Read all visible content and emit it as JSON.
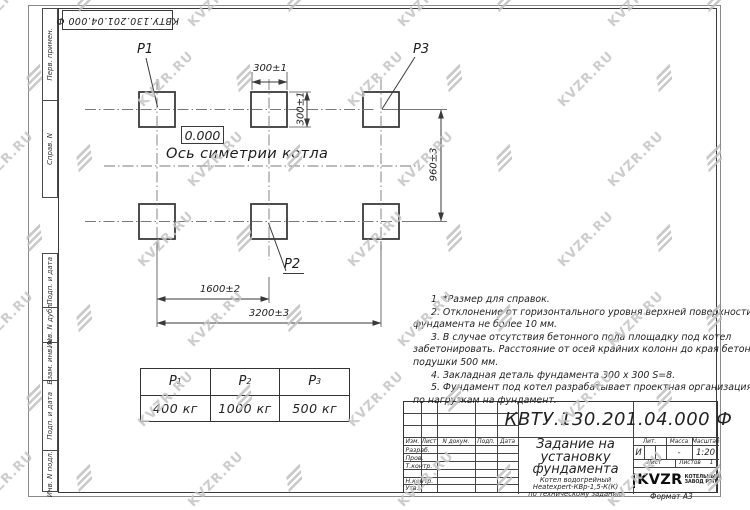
{
  "designation": "КВТУ.130.201.04.000  Ф",
  "labels": {
    "p1": "P1",
    "p2": "P2",
    "p3": "P3",
    "zero_mark": "0.000",
    "axis": "Ось симетрии котла"
  },
  "dims": {
    "w300": "300±1",
    "h300": "300±1",
    "v960": "960±3",
    "w1600": "1600±2",
    "w3200": "3200±3"
  },
  "notes": {
    "lines": [
      "1.  *Размер для справок.",
      "2.  Отклонение от горизонтального уровня верхней поверхности",
      "фундамента не более  10  мм.",
      "3.  В случае отсутствия бетонного пола площадку под котел",
      "забетонировать. Расстояние от осей крайних колонн до края бетонной",
      "подушки  500  мм.",
      "4.  Закладная деталь фундамента  300 х 300  S=8.",
      "5.  Фундамент под котел разрабатывает проектная организация",
      "по нагрузкам на фундамент."
    ]
  },
  "load_table": {
    "headers": [
      {
        "sym": "P",
        "sub": "1"
      },
      {
        "sym": "P",
        "sub": "2"
      },
      {
        "sym": "P",
        "sub": "3"
      }
    ],
    "values": [
      "400  кг",
      "1000  кг",
      "500  кг"
    ]
  },
  "margin": {
    "top_cells": [
      "Перв. примен.",
      "Справ. N"
    ],
    "bottom_cells": [
      "Подп. и дата",
      "Инв. N дубл.",
      "Взам. инв. N",
      "Подп. и дата",
      "Инв. N подл."
    ]
  },
  "titleblock": {
    "columns": [
      "Изм.",
      "Лист",
      "N докум.",
      "Подп.",
      "Дата"
    ],
    "sign_rows": [
      "Разраб.",
      "Пров.",
      "Т.контр.",
      "",
      "Н.контр.",
      "Утв."
    ],
    "title_lines": [
      "Задание на",
      "установку",
      "фундамента"
    ],
    "subtitle_lines": [
      "Котел водогрейный",
      "Heatexpert-КВр-1,5-К(К)",
      "по техническому заданию"
    ],
    "lit_label": "Лит.",
    "mass_label": "Масса",
    "scale_label": "Масштаб",
    "lit_value": "И",
    "mass_value": "-",
    "scale_value": "1:20",
    "sheet_label": "Лист",
    "sheets_label": "Листов",
    "sheets_value": "1",
    "logo_word": "KVZR",
    "logo_sub1": "КОТЕЛЬНЫЙ",
    "logo_sub2": "ЗАВОД РЭП",
    "format": "Формат А3"
  },
  "watermark": {
    "text": "KVZR.RU"
  },
  "colors": {
    "line": "#3a3a3a",
    "centerline": "#787878",
    "watermark": "#c5c5c5",
    "paper": "#ffffff"
  }
}
